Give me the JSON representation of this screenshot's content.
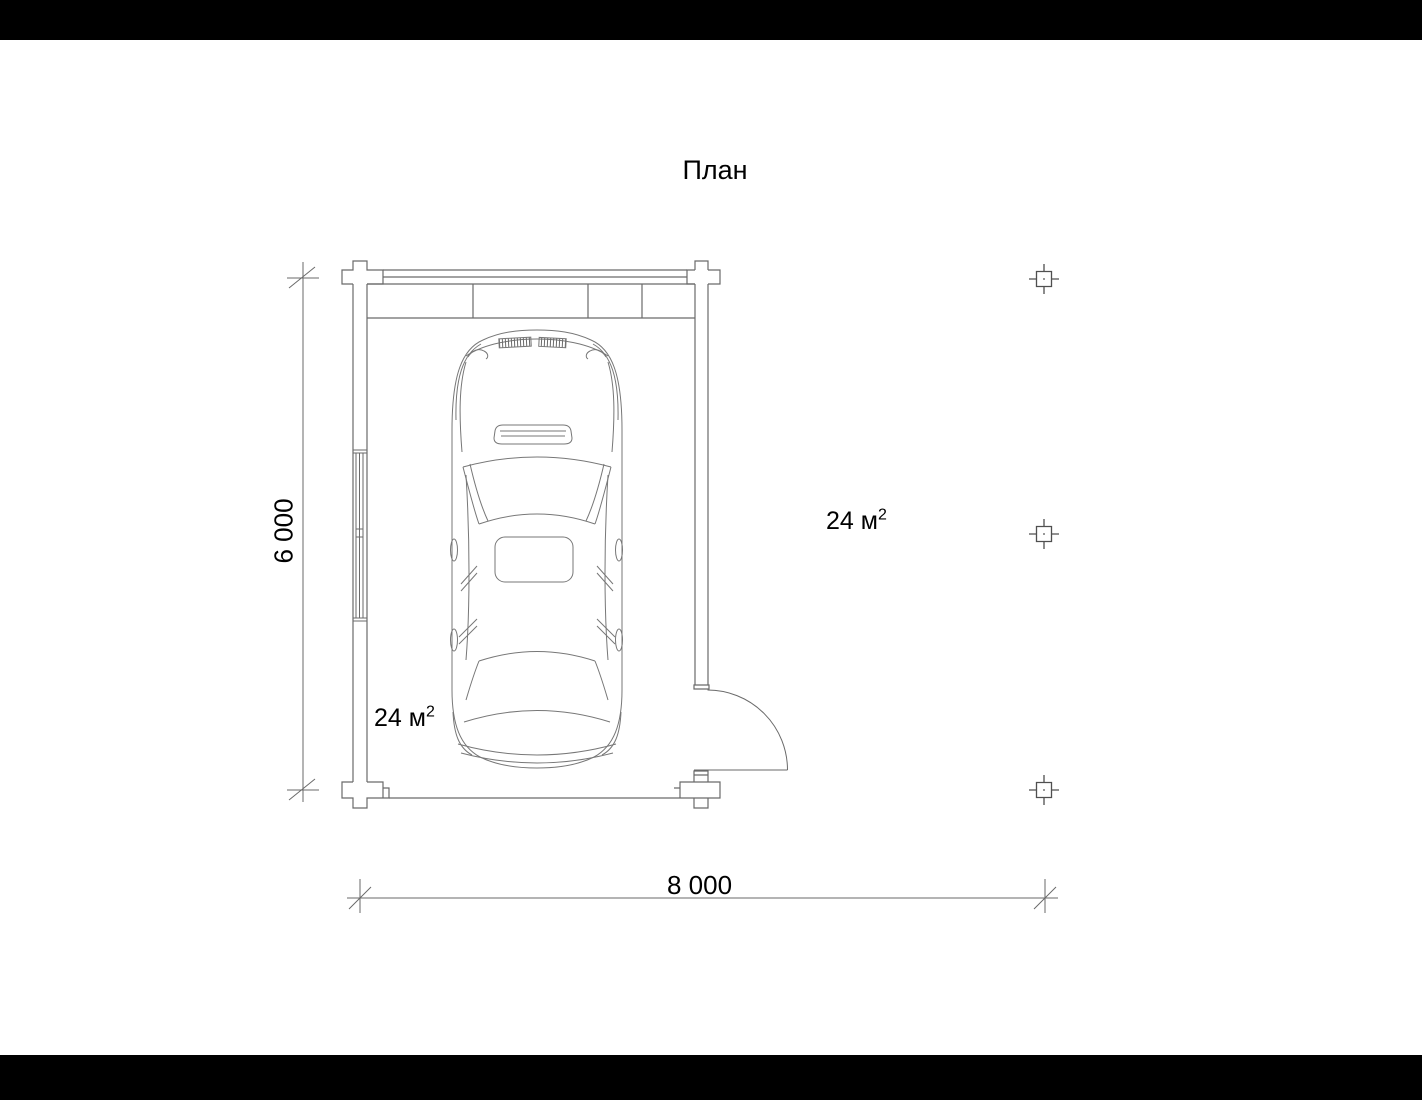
{
  "title": "План",
  "dimensions": {
    "height_label": "6 000",
    "width_label": "8 000"
  },
  "areas": {
    "garage": {
      "value": "24 м",
      "sup": "2"
    },
    "carport": {
      "value": "24 м",
      "sup": "2"
    }
  },
  "colors": {
    "line": "#6a6a6a",
    "marker": "#4f4f4f",
    "text": "#000000",
    "paper": "#ffffff",
    "letterbox": "#000000"
  }
}
